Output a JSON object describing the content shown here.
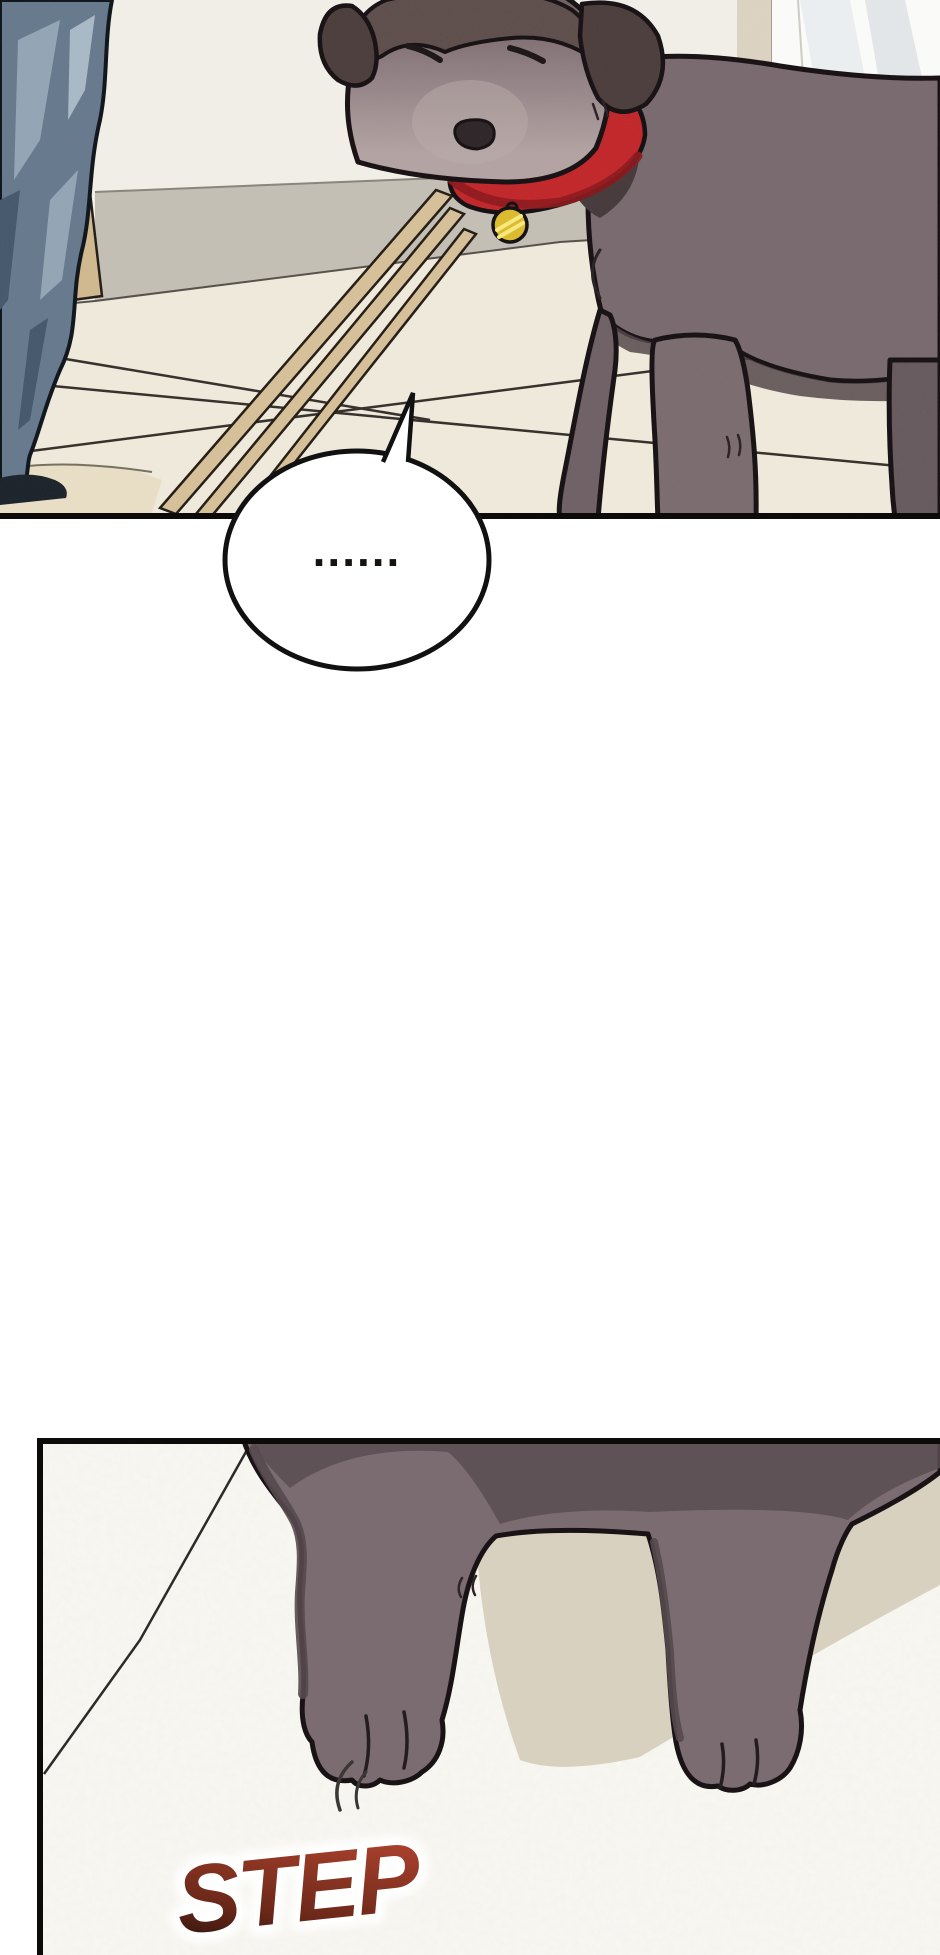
{
  "scene": {
    "type": "webtoon-comic-page",
    "panel1": {
      "description": "A dark grey-brown dog with a red collar and gold tag stands head-lowered on a tiled floor beside a person's blue-grey trouser leg; cream wall, grey baseboard, wooden slats leaning on the wall, white doorway at right"
    },
    "speech_bubble": {
      "text": "......"
    },
    "panel2": {
      "description": "Close-up of the dog's front paws stepping onto a speckled white floor, cast shadow behind, small motion marks by the left paw",
      "sfx": "STEP"
    },
    "colors": {
      "outline": "#171114",
      "wall": "#f2efe8",
      "baseboard": "#c4bfb4",
      "floor": "#efeadb",
      "floor2": "#f8f7f2",
      "shadow_beige": "#d8d1bf",
      "jeans": "#67798d",
      "jeans_light": "#93a5b5",
      "wood": "#d6c099",
      "dog_body": "#786a6e",
      "dog_body2": "#7b6c71",
      "dog_dark_fur": "#4c3e3c",
      "dog_leg_shade": "#564a4f",
      "collar": "#c1272b",
      "collar_shadow": "#8e1a1e",
      "tag": "#dcbb2f",
      "sfx_dark": "#23100b",
      "sfx_mid": "#6b2819",
      "sfx_red": "#a8402c"
    }
  }
}
